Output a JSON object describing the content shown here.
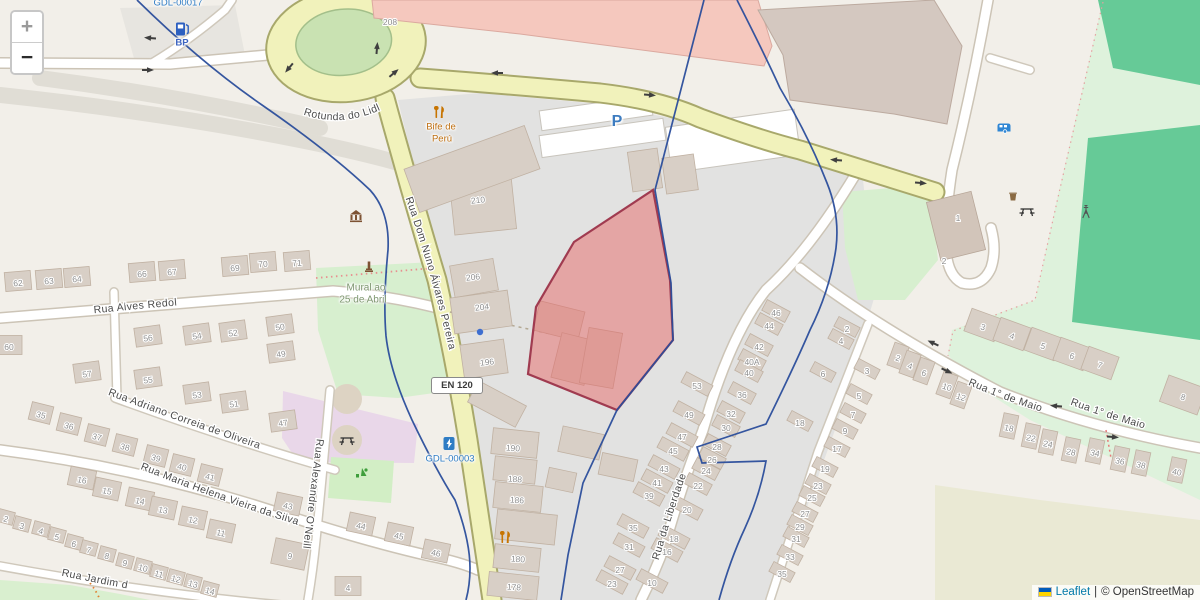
{
  "controls": {
    "zoom_in": "+",
    "zoom_out": "−"
  },
  "attribution": {
    "leaflet": "Leaflet",
    "divider": "|",
    "osm": "© OpenStreetMap"
  },
  "streets": {
    "rotunda": "Rotunda do Lidl",
    "dom_nuno": "Rua Dom Nuno Álvares Pereira",
    "alves_redol": "Rua Alves Redol",
    "adriano": "Rua Adriano Correia de Oliveira",
    "maria_helena": "Rua Maria Helena Vieira da Silva",
    "oneill": "Rua Alexandre O'Neill",
    "jardim": "Rua Jardim d",
    "liberdade": "Rua da Liberdade",
    "maio_a": "Rua 1° de Maio",
    "maio_b": "Rua 1° de Maio",
    "en120": "EN 120"
  },
  "poi_labels": [
    {
      "text": "GDL-00017",
      "x": 178,
      "y": 3,
      "cls": "lbl-ref"
    },
    {
      "text": "BP",
      "x": 182,
      "y": 43,
      "cls": "lbl-blue"
    },
    {
      "text": "Bife de",
      "x": 441,
      "y": 127,
      "cls": "lbl-amber"
    },
    {
      "text": "Perú",
      "x": 442,
      "y": 139,
      "cls": "lbl-amber"
    },
    {
      "text": "P",
      "x": 617,
      "y": 122,
      "cls": "lbl-parking"
    },
    {
      "text": "Mural ao",
      "x": 366,
      "y": 288,
      "cls": "lbl-green"
    },
    {
      "text": "25 de Abril",
      "x": 363,
      "y": 300,
      "cls": "lbl-green"
    },
    {
      "text": "GDL-00003",
      "x": 450,
      "y": 459,
      "cls": "lbl-ref"
    }
  ],
  "map_icons": [
    {
      "t": "fuel",
      "x": 182,
      "y": 29
    },
    {
      "t": "restaurant",
      "x": 440,
      "y": 112
    },
    {
      "t": "museum",
      "x": 356,
      "y": 216
    },
    {
      "t": "monument",
      "x": 369,
      "y": 267
    },
    {
      "t": "picnic",
      "x": 347,
      "y": 440
    },
    {
      "t": "playground",
      "x": 362,
      "y": 473
    },
    {
      "t": "charge",
      "x": 449,
      "y": 444
    },
    {
      "t": "restaurant",
      "x": 506,
      "y": 537
    },
    {
      "t": "caravan",
      "x": 1004,
      "y": 128
    },
    {
      "t": "basket",
      "x": 1013,
      "y": 197
    },
    {
      "t": "picnic",
      "x": 1027,
      "y": 211
    },
    {
      "t": "mast",
      "x": 1086,
      "y": 212
    },
    {
      "t": "dot",
      "x": 480,
      "y": 332
    }
  ],
  "arrows": [
    {
      "x": 150,
      "y": 38,
      "r": 185
    },
    {
      "x": 148,
      "y": 70,
      "r": 0
    },
    {
      "x": 289,
      "y": 68,
      "r": 130
    },
    {
      "x": 377,
      "y": 48,
      "r": 275
    },
    {
      "x": 394,
      "y": 73,
      "r": 320
    },
    {
      "x": 497,
      "y": 73,
      "r": 180
    },
    {
      "x": 650,
      "y": 95,
      "r": 5
    },
    {
      "x": 836,
      "y": 160,
      "r": 185
    },
    {
      "x": 921,
      "y": 183,
      "r": 5
    },
    {
      "x": 933,
      "y": 343,
      "r": 205
    },
    {
      "x": 947,
      "y": 371,
      "r": 25
    },
    {
      "x": 1056,
      "y": 406,
      "r": 185
    },
    {
      "x": 1113,
      "y": 437,
      "r": 5
    }
  ],
  "house_numbers": [
    {
      "t": "62",
      "x": 18,
      "y": 283,
      "r": -5
    },
    {
      "t": "63",
      "x": 49,
      "y": 281,
      "r": -5
    },
    {
      "t": "64",
      "x": 77,
      "y": 279,
      "r": -5
    },
    {
      "t": "66",
      "x": 142,
      "y": 274,
      "r": -5
    },
    {
      "t": "67",
      "x": 172,
      "y": 272,
      "r": -5
    },
    {
      "t": "69",
      "x": 235,
      "y": 268,
      "r": -5
    },
    {
      "t": "70",
      "x": 263,
      "y": 264,
      "r": -5
    },
    {
      "t": "71",
      "x": 297,
      "y": 263,
      "r": -5
    },
    {
      "t": "60",
      "x": 9,
      "y": 347,
      "r": 0
    },
    {
      "t": "56",
      "x": 148,
      "y": 338,
      "r": -8
    },
    {
      "t": "54",
      "x": 197,
      "y": 336,
      "r": -8
    },
    {
      "t": "52",
      "x": 233,
      "y": 333,
      "r": -8
    },
    {
      "t": "50",
      "x": 280,
      "y": 327,
      "r": -8
    },
    {
      "t": "49",
      "x": 281,
      "y": 354,
      "r": -8
    },
    {
      "t": "57",
      "x": 87,
      "y": 374,
      "r": -8
    },
    {
      "t": "55",
      "x": 148,
      "y": 380,
      "r": -8
    },
    {
      "t": "53",
      "x": 197,
      "y": 395,
      "r": -8
    },
    {
      "t": "51",
      "x": 234,
      "y": 404,
      "r": -8
    },
    {
      "t": "47",
      "x": 283,
      "y": 423,
      "r": -8
    },
    {
      "t": "35",
      "x": 41,
      "y": 415,
      "r": 14,
      "bw": 22,
      "bh": 18
    },
    {
      "t": "36",
      "x": 69,
      "y": 426,
      "r": 14,
      "bw": 22,
      "bh": 18
    },
    {
      "t": "37",
      "x": 97,
      "y": 437,
      "r": 14,
      "bw": 22,
      "bh": 18
    },
    {
      "t": "38",
      "x": 125,
      "y": 447,
      "r": 14,
      "bw": 22,
      "bh": 18
    },
    {
      "t": "39",
      "x": 156,
      "y": 458,
      "r": 14,
      "bw": 22,
      "bh": 18
    },
    {
      "t": "40",
      "x": 182,
      "y": 467,
      "r": 14,
      "bw": 22,
      "bh": 18
    },
    {
      "t": "41",
      "x": 210,
      "y": 477,
      "r": 14,
      "bw": 22,
      "bh": 18
    },
    {
      "t": "16",
      "x": 82,
      "y": 480,
      "r": 12
    },
    {
      "t": "15",
      "x": 107,
      "y": 491,
      "r": 12
    },
    {
      "t": "14",
      "x": 140,
      "y": 501,
      "r": 12
    },
    {
      "t": "13",
      "x": 163,
      "y": 510,
      "r": 12
    },
    {
      "t": "12",
      "x": 193,
      "y": 520,
      "r": 12
    },
    {
      "t": "11",
      "x": 221,
      "y": 533,
      "r": 12
    },
    {
      "t": "43",
      "x": 288,
      "y": 506,
      "r": 12
    },
    {
      "t": "9",
      "x": 290,
      "y": 556,
      "r": 12,
      "bw": 34,
      "bh": 26
    },
    {
      "t": "2",
      "x": 6,
      "y": 519,
      "r": 15,
      "bw": 16,
      "bh": 13
    },
    {
      "t": "3",
      "x": 22,
      "y": 526,
      "r": 15,
      "bw": 16,
      "bh": 13
    },
    {
      "t": "4",
      "x": 41,
      "y": 531,
      "r": 15,
      "bw": 16,
      "bh": 13
    },
    {
      "t": "5",
      "x": 57,
      "y": 537,
      "r": 15,
      "bw": 16,
      "bh": 13
    },
    {
      "t": "6",
      "x": 74,
      "y": 544,
      "r": 15,
      "bw": 16,
      "bh": 13
    },
    {
      "t": "7",
      "x": 89,
      "y": 550,
      "r": 15,
      "bw": 16,
      "bh": 13
    },
    {
      "t": "8",
      "x": 107,
      "y": 556,
      "r": 15,
      "bw": 16,
      "bh": 13
    },
    {
      "t": "9",
      "x": 125,
      "y": 563,
      "r": 15,
      "bw": 16,
      "bh": 13
    },
    {
      "t": "10",
      "x": 143,
      "y": 568,
      "r": 15,
      "bw": 16,
      "bh": 13
    },
    {
      "t": "11",
      "x": 159,
      "y": 574,
      "r": 15,
      "bw": 16,
      "bh": 13
    },
    {
      "t": "12",
      "x": 176,
      "y": 579,
      "r": 15,
      "bw": 16,
      "bh": 13
    },
    {
      "t": "13",
      "x": 193,
      "y": 584,
      "r": 15,
      "bw": 16,
      "bh": 13
    },
    {
      "t": "14",
      "x": 210,
      "y": 591,
      "r": 15,
      "bw": 16,
      "bh": 13
    },
    {
      "t": "44",
      "x": 361,
      "y": 526,
      "r": 12
    },
    {
      "t": "45",
      "x": 399,
      "y": 536,
      "r": 12
    },
    {
      "t": "46",
      "x": 436,
      "y": 553,
      "r": 12
    },
    {
      "t": "4",
      "x": 348,
      "y": 588,
      "r": 0
    },
    {
      "t": "208",
      "x": 390,
      "y": 22,
      "r": 0,
      "b": 0
    },
    {
      "t": "210",
      "x": 478,
      "y": 200,
      "r": -6,
      "b": 0
    },
    {
      "t": "206",
      "x": 473,
      "y": 277,
      "r": -6,
      "b": 0
    },
    {
      "t": "204",
      "x": 482,
      "y": 307,
      "r": -6,
      "b": 0
    },
    {
      "t": "196",
      "x": 487,
      "y": 362,
      "r": -6,
      "b": 0
    },
    {
      "t": "190",
      "x": 513,
      "y": 448,
      "r": 4,
      "b": 0
    },
    {
      "t": "188",
      "x": 515,
      "y": 479,
      "r": 4,
      "b": 0
    },
    {
      "t": "186",
      "x": 517,
      "y": 500,
      "r": 4,
      "b": 0
    },
    {
      "t": "180",
      "x": 518,
      "y": 559,
      "r": 4,
      "b": 0
    },
    {
      "t": "178",
      "x": 514,
      "y": 587,
      "r": 4,
      "b": 0
    },
    {
      "t": "53",
      "x": 697,
      "y": 386,
      "r": 0,
      "bw": 30,
      "bh": 12,
      "br": 28
    },
    {
      "t": "49",
      "x": 689,
      "y": 415,
      "r": 0,
      "bw": 30,
      "bh": 12,
      "br": 28
    },
    {
      "t": "47",
      "x": 682,
      "y": 437,
      "r": 0,
      "bw": 30,
      "bh": 12,
      "br": 28
    },
    {
      "t": "45",
      "x": 673,
      "y": 451,
      "r": 0,
      "bw": 30,
      "bh": 12,
      "br": 28
    },
    {
      "t": "43",
      "x": 664,
      "y": 469,
      "r": 0,
      "bw": 30,
      "bh": 12,
      "br": 28
    },
    {
      "t": "41",
      "x": 657,
      "y": 483,
      "r": 0,
      "bw": 30,
      "bh": 12,
      "br": 28
    },
    {
      "t": "39",
      "x": 649,
      "y": 496,
      "r": 0,
      "bw": 30,
      "bh": 12,
      "br": 28
    },
    {
      "t": "20",
      "x": 687,
      "y": 510,
      "r": 0,
      "bw": 30,
      "bh": 12,
      "br": 28
    },
    {
      "t": "18",
      "x": 674,
      "y": 539,
      "r": 0,
      "bw": 30,
      "bh": 12,
      "br": 28
    },
    {
      "t": "16",
      "x": 667,
      "y": 552,
      "r": 0,
      "bw": 30,
      "bh": 12,
      "br": 28
    },
    {
      "t": "35",
      "x": 633,
      "y": 528,
      "r": 0,
      "bw": 30,
      "bh": 12,
      "br": 28
    },
    {
      "t": "31",
      "x": 629,
      "y": 547,
      "r": 0,
      "bw": 30,
      "bh": 12,
      "br": 28
    },
    {
      "t": "27",
      "x": 620,
      "y": 570,
      "r": 0,
      "bw": 30,
      "bh": 12,
      "br": 28
    },
    {
      "t": "23",
      "x": 612,
      "y": 584,
      "r": 0,
      "bw": 30,
      "bh": 12,
      "br": 28
    },
    {
      "t": "10",
      "x": 652,
      "y": 583,
      "r": 0,
      "bw": 30,
      "bh": 12,
      "br": 28
    },
    {
      "t": "46",
      "x": 776,
      "y": 313,
      "r": 0,
      "bw": 26,
      "bh": 12,
      "br": 28
    },
    {
      "t": "44",
      "x": 769,
      "y": 326,
      "r": 0,
      "bw": 26,
      "bh": 12,
      "br": 28
    },
    {
      "t": "42",
      "x": 759,
      "y": 347,
      "r": 0,
      "bw": 26,
      "bh": 12,
      "br": 28
    },
    {
      "t": "40A",
      "x": 752,
      "y": 362,
      "r": 0,
      "bw": 26,
      "bh": 12,
      "br": 28
    },
    {
      "t": "40",
      "x": 749,
      "y": 373,
      "r": 0,
      "bw": 26,
      "bh": 12,
      "br": 28
    },
    {
      "t": "36",
      "x": 742,
      "y": 395,
      "r": 0,
      "bw": 26,
      "bh": 12,
      "br": 28
    },
    {
      "t": "32",
      "x": 731,
      "y": 414,
      "r": 0,
      "bw": 26,
      "bh": 12,
      "br": 28
    },
    {
      "t": "30",
      "x": 726,
      "y": 428,
      "r": 0,
      "bw": 26,
      "bh": 12,
      "br": 28
    },
    {
      "t": "28",
      "x": 717,
      "y": 447,
      "r": 0,
      "bw": 26,
      "bh": 12,
      "br": 28
    },
    {
      "t": "26",
      "x": 712,
      "y": 460,
      "r": 0,
      "bw": 26,
      "bh": 12,
      "br": 28
    },
    {
      "t": "24",
      "x": 706,
      "y": 471,
      "r": 0,
      "bw": 26,
      "bh": 12,
      "br": 28
    },
    {
      "t": "22",
      "x": 698,
      "y": 486,
      "r": 0,
      "bw": 26,
      "bh": 12,
      "br": 28
    },
    {
      "t": "6",
      "x": 823,
      "y": 374,
      "r": 0,
      "bw": 24,
      "bh": 11,
      "br": 28
    },
    {
      "t": "18",
      "x": 800,
      "y": 423,
      "r": 0,
      "bw": 24,
      "bh": 11,
      "br": 28
    },
    {
      "t": "2",
      "x": 847,
      "y": 329,
      "r": 0,
      "bw": 24,
      "bh": 11,
      "br": 28
    },
    {
      "t": "4",
      "x": 841,
      "y": 341,
      "r": 0,
      "bw": 24,
      "bh": 11,
      "br": 28
    },
    {
      "t": "3",
      "x": 867,
      "y": 371,
      "r": 0,
      "bw": 24,
      "bh": 11,
      "br": 28
    },
    {
      "t": "5",
      "x": 859,
      "y": 396,
      "r": 0,
      "bw": 24,
      "bh": 11,
      "br": 28
    },
    {
      "t": "7",
      "x": 853,
      "y": 415,
      "r": 0,
      "bw": 24,
      "bh": 11,
      "br": 28
    },
    {
      "t": "9",
      "x": 845,
      "y": 431,
      "r": 0,
      "bw": 24,
      "bh": 11,
      "br": 28
    },
    {
      "t": "17",
      "x": 837,
      "y": 449,
      "r": 0,
      "bw": 24,
      "bh": 11,
      "br": 28
    },
    {
      "t": "19",
      "x": 825,
      "y": 469,
      "r": 0,
      "bw": 24,
      "bh": 11,
      "br": 28
    },
    {
      "t": "23",
      "x": 818,
      "y": 486,
      "r": 0,
      "bw": 24,
      "bh": 11,
      "br": 28
    },
    {
      "t": "25",
      "x": 812,
      "y": 498,
      "r": 0,
      "bw": 24,
      "bh": 11,
      "br": 28
    },
    {
      "t": "27",
      "x": 805,
      "y": 514,
      "r": 0,
      "bw": 24,
      "bh": 11,
      "br": 28
    },
    {
      "t": "29",
      "x": 800,
      "y": 527,
      "r": 0,
      "bw": 24,
      "bh": 11,
      "br": 28
    },
    {
      "t": "31",
      "x": 796,
      "y": 539,
      "r": 0,
      "bw": 24,
      "bh": 11,
      "br": 28
    },
    {
      "t": "33",
      "x": 790,
      "y": 557,
      "r": 0,
      "bw": 24,
      "bh": 11,
      "br": 28
    },
    {
      "t": "35",
      "x": 782,
      "y": 574,
      "r": 0,
      "bw": 24,
      "bh": 11,
      "br": 28
    },
    {
      "t": "3",
      "x": 983,
      "y": 327,
      "r": 18,
      "bw": 32,
      "bh": 24,
      "br": 20
    },
    {
      "t": "4",
      "x": 1012,
      "y": 336,
      "r": 18,
      "bw": 32,
      "bh": 24,
      "br": 20
    },
    {
      "t": "5",
      "x": 1043,
      "y": 346,
      "r": 18,
      "bw": 32,
      "bh": 24,
      "br": 20
    },
    {
      "t": "6",
      "x": 1072,
      "y": 356,
      "r": 18,
      "bw": 32,
      "bh": 24,
      "br": 20
    },
    {
      "t": "7",
      "x": 1100,
      "y": 365,
      "r": 18,
      "bw": 32,
      "bh": 24,
      "br": 20
    },
    {
      "t": "8",
      "x": 1183,
      "y": 397,
      "r": 18,
      "bw": 40,
      "bh": 28,
      "br": 20
    },
    {
      "t": "2",
      "x": 898,
      "y": 358,
      "r": 18,
      "bw": 15,
      "bh": 24,
      "br": 20
    },
    {
      "t": "4",
      "x": 910,
      "y": 366,
      "r": 18,
      "bw": 15,
      "bh": 24,
      "br": 20
    },
    {
      "t": "6",
      "x": 924,
      "y": 373,
      "r": 18,
      "bw": 15,
      "bh": 24,
      "br": 20
    },
    {
      "t": "10",
      "x": 947,
      "y": 387,
      "r": 18,
      "bw": 15,
      "bh": 24,
      "br": 20
    },
    {
      "t": "12",
      "x": 961,
      "y": 397,
      "r": 18,
      "bw": 15,
      "bh": 24,
      "br": 20
    },
    {
      "t": "18",
      "x": 1009,
      "y": 428,
      "r": 12,
      "bw": 15,
      "bh": 24,
      "br": 12
    },
    {
      "t": "22",
      "x": 1031,
      "y": 438,
      "r": 12,
      "bw": 15,
      "bh": 24,
      "br": 12
    },
    {
      "t": "24",
      "x": 1048,
      "y": 444,
      "r": 12,
      "bw": 15,
      "bh": 24,
      "br": 12
    },
    {
      "t": "28",
      "x": 1071,
      "y": 452,
      "r": 12,
      "bw": 15,
      "bh": 24,
      "br": 12
    },
    {
      "t": "34",
      "x": 1095,
      "y": 453,
      "r": 12,
      "bw": 15,
      "bh": 24,
      "br": 12
    },
    {
      "t": "36",
      "x": 1120,
      "y": 461,
      "r": 12,
      "bw": 15,
      "bh": 24,
      "br": 12
    },
    {
      "t": "38",
      "x": 1141,
      "y": 465,
      "r": 12,
      "bw": 15,
      "bh": 24,
      "br": 12
    },
    {
      "t": "40",
      "x": 1177,
      "y": 472,
      "r": 12,
      "bw": 15,
      "bh": 24,
      "br": 12
    },
    {
      "t": "1",
      "x": 958,
      "y": 218,
      "r": 0,
      "b": 0
    },
    {
      "t": "2",
      "x": 944,
      "y": 261,
      "r": 0,
      "b": 0
    }
  ]
}
